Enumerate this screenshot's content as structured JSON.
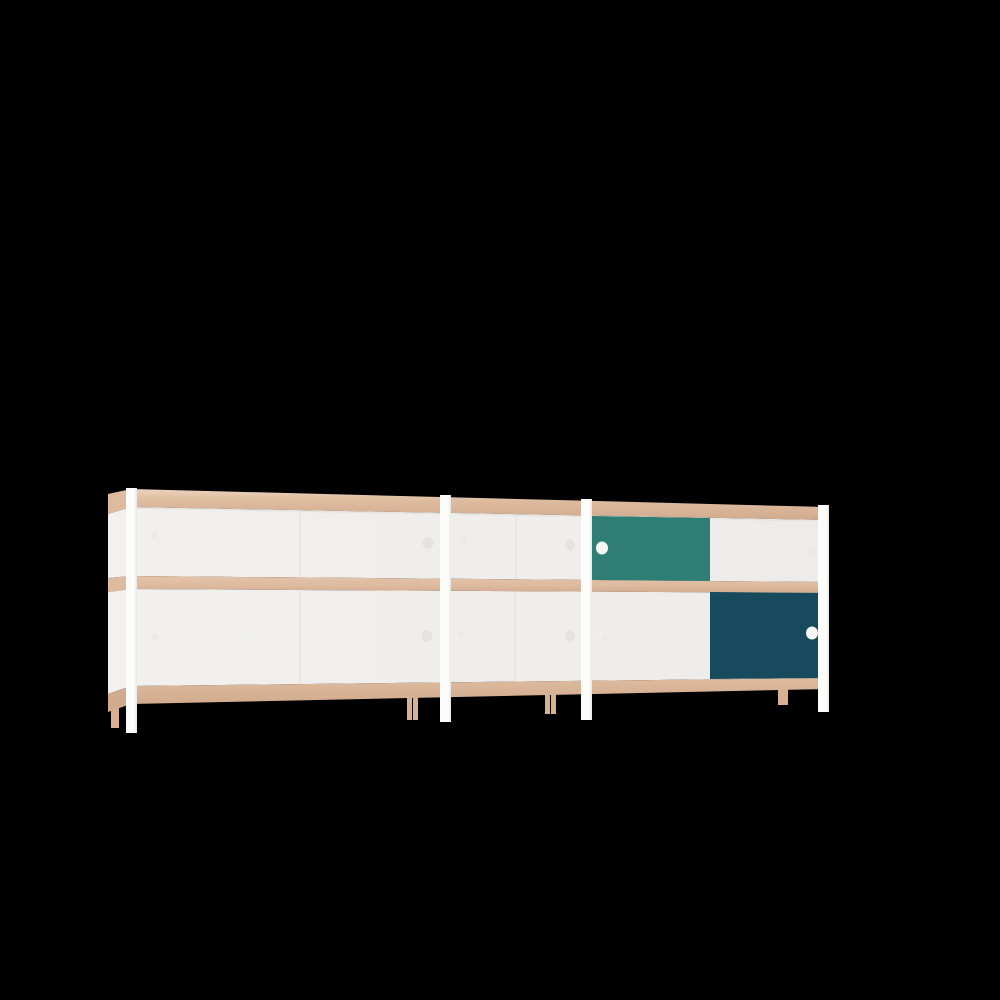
{
  "scene": {
    "kind": "3d-product-render",
    "subject": "modular sideboard with sliding doors, viewed in perspective from the left",
    "background_color": "#000000"
  },
  "colors": {
    "background": "#000000",
    "wood_top_lip": "#ecd3bb",
    "wood_edge": "#debb9f",
    "wood_mid_light": "#e3c3a9",
    "wood_edge_dark": "#d2ab8e",
    "wood_leg": "#d9b191",
    "panel_white": "#f1f0ee",
    "panel_white_dim": "#eeecea",
    "side_white": "#f3f1ef",
    "frame_white": "#fcfcfb",
    "frame_shadow": "#e8e6e4",
    "teal": "#2f7e75",
    "petrol": "#164a5c",
    "handle_white": "#f6f7f5",
    "handle_gray": "#e5e3e0",
    "handle_faint": "#eceae7",
    "seam": "#e3e1de"
  },
  "furniture": {
    "type": "sideboard",
    "rows": 2,
    "modules": [
      {
        "name": "left-wide-module",
        "top_doors": [
          "white",
          "white"
        ],
        "bottom_doors": [
          "white",
          "white"
        ]
      },
      {
        "name": "middle-narrow-module",
        "top_doors": [
          "white"
        ],
        "bottom_doors": [
          "white"
        ]
      },
      {
        "name": "right-wide-module",
        "top_doors": [
          "teal",
          "white"
        ],
        "bottom_doors": [
          "white",
          "petrol"
        ]
      }
    ],
    "frame": "white vertical posts with legs at module junctions",
    "edges": "exposed plywood-tone horizontal bands (top, middle shelf, bottom)",
    "back_legs": "wood-tone",
    "handles": "round finger holes",
    "accent_door_top": "teal sliding door, right module, upper row, left position",
    "accent_door_bottom": "petrol sliding door, right module, lower row, right position"
  }
}
